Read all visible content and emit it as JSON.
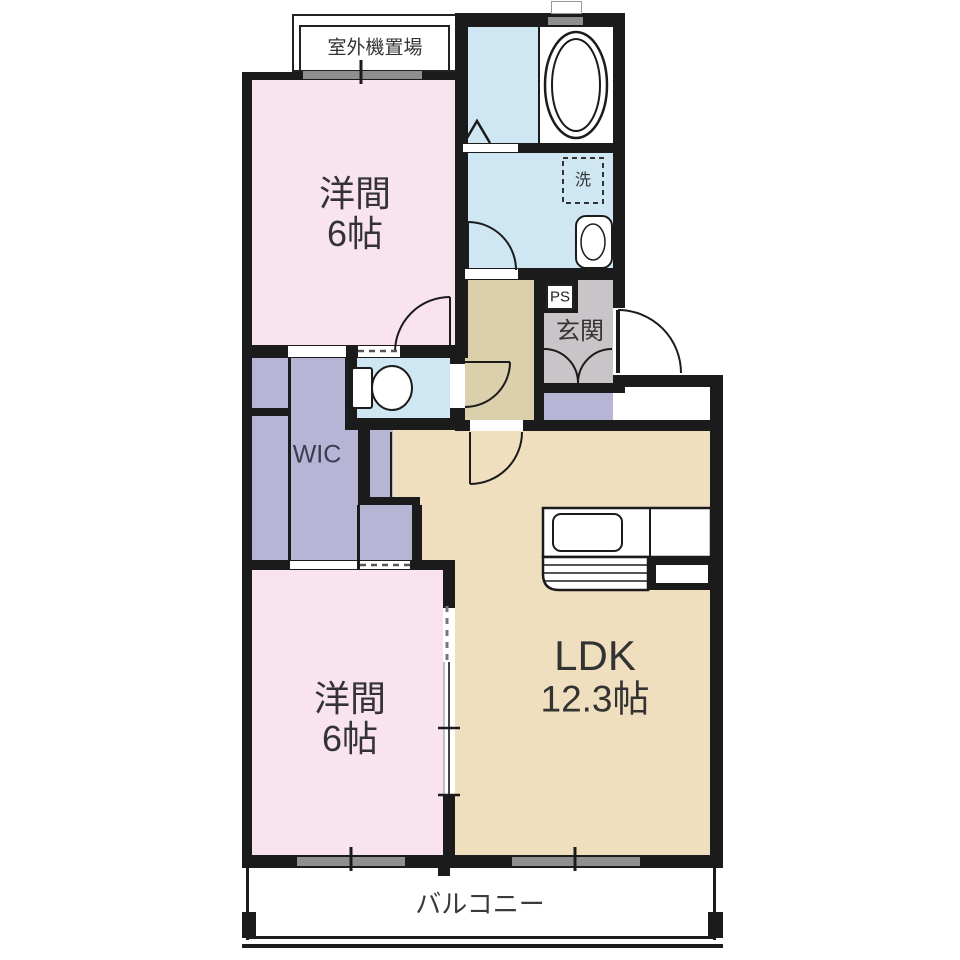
{
  "floorplan": {
    "bedroom1": {
      "label": "洋間",
      "size": "6帖"
    },
    "bedroom2": {
      "label": "洋間",
      "size": "6帖"
    },
    "ldk": {
      "label": "LDK",
      "size": "12.3帖"
    },
    "wic": {
      "label": "WIC"
    },
    "entrance": {
      "label": "玄関"
    },
    "balcony": {
      "label": "バルコニー"
    },
    "outdoor_unit": {
      "label": "室外機置場"
    },
    "pipe_space": {
      "label": "PS"
    },
    "washer": {
      "label": "洗"
    }
  },
  "colors": {
    "wall": "#1b1b1b",
    "pink": "#f8e3ef",
    "lavender": "#b7b5d6",
    "blue": "#cfe7f3",
    "beige": "#f0dfbf",
    "tan": "#dccfab",
    "gray": "#c8c4c8",
    "window": "#8f8f8f",
    "ink": "#333333"
  }
}
